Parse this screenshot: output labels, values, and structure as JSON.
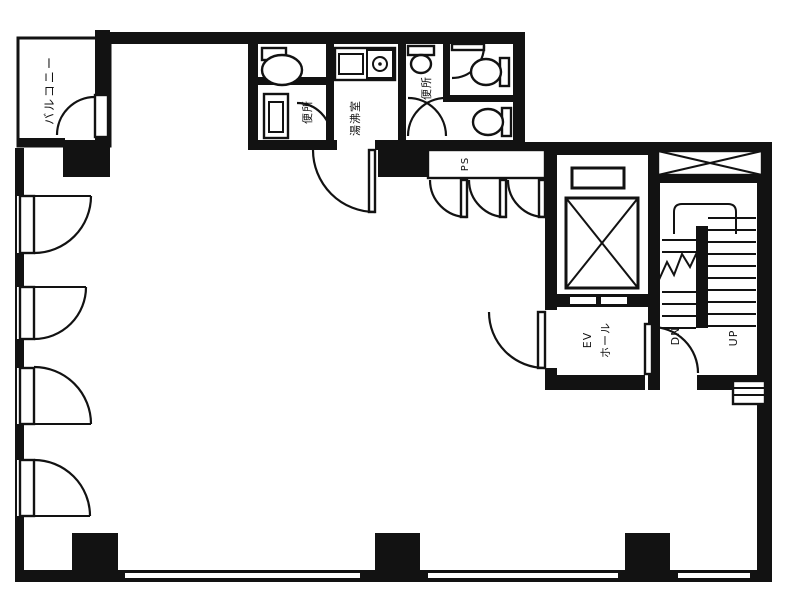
{
  "labels": {
    "balcony": "バルコニー",
    "toilet_west": "便所",
    "kitchenette": "湯沸室",
    "toilet_east": "便所",
    "pipe_shaft": "PS",
    "ev_hall_line1": "EV",
    "ev_hall_line2": "ホール",
    "stair_down": "DN",
    "stair_up": "UP"
  },
  "colors": {
    "ink": "#121212",
    "paper": "#ffffff"
  }
}
